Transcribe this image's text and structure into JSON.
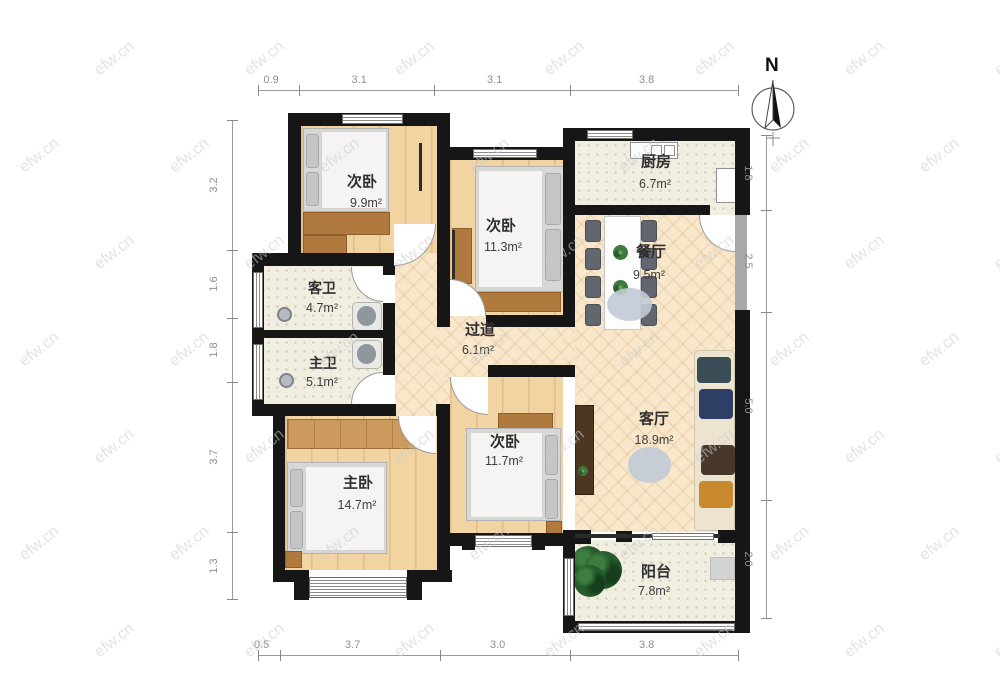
{
  "compass": {
    "label": "N"
  },
  "watermark": {
    "text": "efw.cn"
  },
  "rooms": [
    {
      "id": "bedroom-a",
      "name": "次卧",
      "area": "9.9m²"
    },
    {
      "id": "bedroom-b",
      "name": "次卧",
      "area": "11.3m²"
    },
    {
      "id": "kitchen",
      "name": "厨房",
      "area": "6.7m²"
    },
    {
      "id": "dining",
      "name": "餐厅",
      "area": "9.5m²"
    },
    {
      "id": "guest-bath",
      "name": "客卫",
      "area": "4.7m²"
    },
    {
      "id": "master-bath",
      "name": "主卫",
      "area": "5.1m²"
    },
    {
      "id": "hallway",
      "name": "过道",
      "area": "6.1m²"
    },
    {
      "id": "bedroom-c",
      "name": "次卧",
      "area": "11.7m²"
    },
    {
      "id": "living",
      "name": "客厅",
      "area": "18.9m²"
    },
    {
      "id": "master-bedroom",
      "name": "主卧",
      "area": "14.7m²"
    },
    {
      "id": "balcony",
      "name": "阳台",
      "area": "7.8m²"
    }
  ],
  "dimensions": {
    "top": [
      "0.9",
      "3.1",
      "3.1",
      "3.8"
    ],
    "left": [
      "3.2",
      "1.6",
      "1.8",
      "3.7",
      "1.3"
    ],
    "right": [
      "1.8",
      "2.5",
      "5.0",
      "2.0"
    ],
    "bottom": [
      "0.5",
      "3.7",
      "3.0",
      "3.8"
    ]
  },
  "colors": {
    "wall": "#161616",
    "wood_floor": "#f2d3a2",
    "herringbone_floor": "#f8e7cb",
    "tile_floor": "#f0ede1",
    "dimension_text": "#8f8f8f"
  }
}
